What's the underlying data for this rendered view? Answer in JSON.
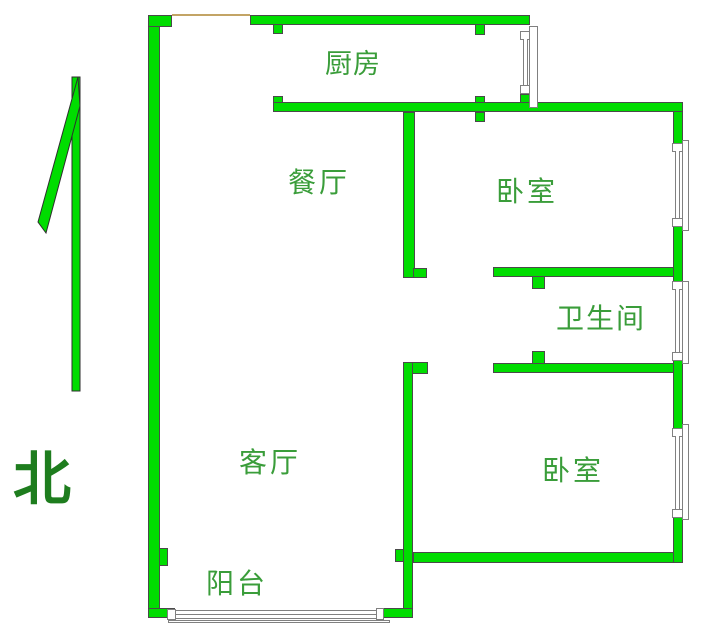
{
  "compass": {
    "label": "北",
    "direction": "north-arrow"
  },
  "rooms": {
    "kitchen": "厨房",
    "dining": "餐厅",
    "bedroom_top": "卧室",
    "bathroom": "卫生间",
    "living": "客厅",
    "bedroom_bottom": "卧室",
    "balcony": "阳台"
  },
  "colors": {
    "wall_fill": "#00dd00",
    "wall_outline": "#4a4a4a",
    "label_text": "#3a9d3a",
    "compass_text": "#1e7d1e",
    "window_line": "#808080",
    "door_line": "#c3a465"
  }
}
